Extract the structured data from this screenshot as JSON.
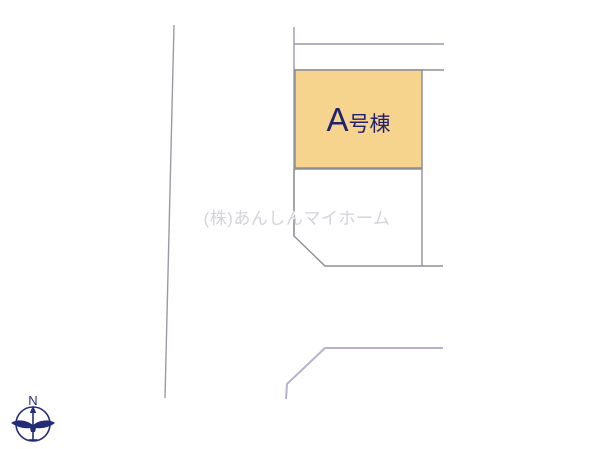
{
  "plan": {
    "parcel_a": {
      "letter": "A",
      "suffix": "号棟",
      "full_label": "A号棟"
    },
    "watermark": "(株)あんしんマイホーム",
    "compass": {
      "label": "N"
    }
  },
  "colors": {
    "background": "#ffffff",
    "parcel_fill": "#f6d48e",
    "parcel_border": "#8e8e96",
    "boundary_line": "#9a9aa6",
    "road_line": "#b4b4cc",
    "label_text": "#21216e",
    "watermark_text": "#d3d3db",
    "compass": "#232c78"
  }
}
